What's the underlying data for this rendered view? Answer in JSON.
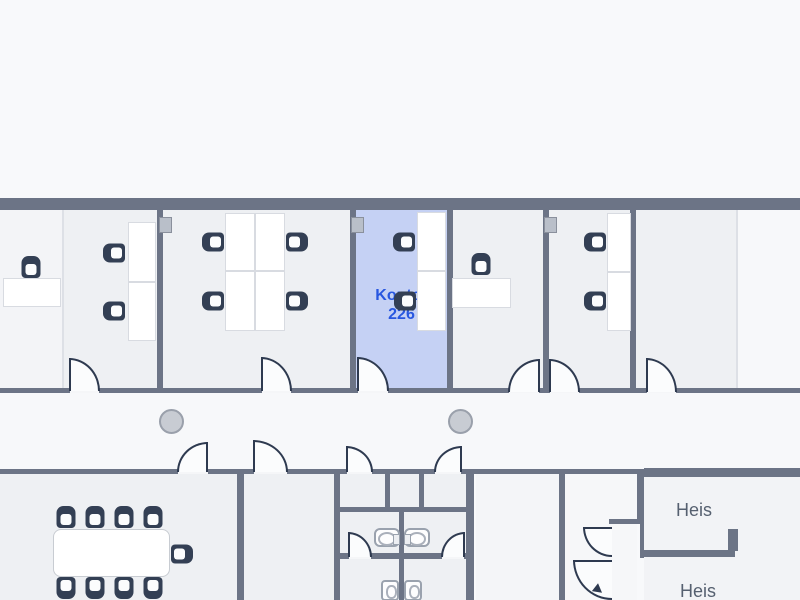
{
  "labels": {
    "room": {
      "line1": "Kontor",
      "line2": "226"
    },
    "elevator_top": "Heis",
    "elevator_bottom": "Heis"
  },
  "colors": {
    "wall": "#6c7486",
    "room_fill": "#eef0f3",
    "corridor_fill": "#f7f8fa",
    "highlight_room_fill": "#c5d1f4",
    "highlight_label": "#2857e0",
    "door_stroke": "#2e3a50",
    "chair": "#333f54",
    "column_fill": "#c8ccd3",
    "elevator_label": "#566070"
  },
  "geometry": {
    "rooms": [
      {
        "r": [
          0,
          210,
          62,
          178
        ],
        "f": "#f3f4f7",
        "name": "open-area-left",
        "i": false
      },
      {
        "r": [
          64,
          210,
          93,
          178
        ],
        "f": "#eef0f3",
        "name": "office-room-1",
        "i": true
      },
      {
        "r": [
          163,
          210,
          187,
          178
        ],
        "f": "#eef0f3",
        "name": "office-room-2",
        "i": true
      },
      {
        "r": [
          356,
          210,
          91,
          178
        ],
        "f": "#c5d1f4",
        "name": "room-kontor-226",
        "i": true
      },
      {
        "r": [
          453,
          210,
          90,
          178
        ],
        "f": "#eef0f3",
        "name": "office-room-3",
        "i": true
      },
      {
        "r": [
          549,
          210,
          81,
          178
        ],
        "f": "#eef0f3",
        "name": "office-room-4",
        "i": true
      },
      {
        "r": [
          636,
          210,
          100,
          178
        ],
        "f": "#eef0f3",
        "name": "office-room-5",
        "i": true
      },
      {
        "r": [
          738,
          210,
          62,
          178
        ],
        "f": "#f7f8fa",
        "name": "open-area-right",
        "i": false
      },
      {
        "r": [
          0,
          393,
          800,
          76
        ],
        "f": "#f7f8fa",
        "name": "corridor",
        "i": false
      },
      {
        "r": [
          0,
          474,
          237,
          126
        ],
        "f": "#eef0f3",
        "name": "meeting-room",
        "i": true
      },
      {
        "r": [
          244,
          474,
          90,
          126
        ],
        "f": "#eef0f3",
        "name": "small-room",
        "i": true
      },
      {
        "r": [
          340,
          474,
          132,
          126
        ],
        "f": "#eef0f3",
        "name": "restroom-area",
        "i": true
      },
      {
        "r": [
          476,
          474,
          83,
          126
        ],
        "f": "#f4f5f8",
        "name": "utility-room",
        "i": true
      },
      {
        "r": [
          565,
          474,
          72,
          126
        ],
        "f": "#f6f7f9",
        "name": "stairwell",
        "i": true
      },
      {
        "r": [
          644,
          477,
          156,
          123
        ],
        "f": "#f2f3f6",
        "name": "elevator-area",
        "i": true
      }
    ],
    "walls": [
      [
        0,
        198,
        800,
        12
      ],
      [
        0,
        388,
        800,
        5
      ],
      [
        0,
        469,
        644,
        5
      ],
      [
        644,
        468,
        156,
        9
      ],
      [
        157,
        210,
        6,
        178
      ],
      [
        350,
        210,
        6,
        178
      ],
      [
        447,
        210,
        6,
        178
      ],
      [
        543,
        210,
        6,
        178
      ],
      [
        630,
        210,
        6,
        178
      ],
      [
        237,
        474,
        7,
        126
      ],
      [
        334,
        474,
        6,
        126
      ],
      [
        385,
        474,
        5,
        38
      ],
      [
        419,
        474,
        5,
        38
      ],
      [
        334,
        507,
        140,
        5
      ],
      [
        399,
        512,
        5,
        88
      ],
      [
        334,
        553,
        140,
        6
      ],
      [
        466,
        474,
        8,
        126
      ],
      [
        559,
        474,
        6,
        126
      ],
      [
        637,
        474,
        7,
        50
      ],
      [
        640,
        524,
        4,
        34
      ],
      [
        609,
        519,
        35,
        5
      ],
      [
        643,
        550,
        92,
        7
      ],
      [
        728,
        529,
        10,
        22
      ]
    ],
    "partitions": [
      [
        62,
        210,
        2,
        178
      ],
      [
        736,
        210,
        2,
        178
      ]
    ],
    "thresholds": [
      [
        70,
        389,
        29,
        4
      ],
      [
        262,
        389,
        29,
        4
      ],
      [
        358,
        389,
        30,
        4
      ],
      [
        509,
        389,
        30,
        4
      ],
      [
        550,
        389,
        29,
        4
      ],
      [
        647,
        389,
        29,
        4
      ],
      [
        178,
        470,
        30,
        4
      ],
      [
        254,
        470,
        33,
        4
      ],
      [
        347,
        470,
        25,
        4
      ],
      [
        435,
        470,
        26,
        4
      ],
      [
        349,
        554,
        22,
        5
      ],
      [
        442,
        554,
        22,
        5
      ]
    ],
    "desks": [
      [
        3,
        278,
        58,
        29
      ],
      [
        128,
        222,
        28,
        60
      ],
      [
        128,
        282,
        28,
        59
      ],
      [
        225,
        213,
        30,
        58
      ],
      [
        255,
        213,
        30,
        58
      ],
      [
        225,
        271,
        30,
        60
      ],
      [
        255,
        271,
        30,
        60
      ],
      [
        417,
        212,
        29,
        59
      ],
      [
        417,
        271,
        29,
        60
      ],
      [
        452,
        278,
        59,
        30
      ],
      [
        607,
        213,
        24,
        59
      ],
      [
        607,
        272,
        24,
        59
      ]
    ],
    "meeting_table": [
      53,
      529,
      117,
      48
    ],
    "chairs": [
      {
        "c": [
          31,
          267
        ],
        "d": "down"
      },
      {
        "c": [
          114,
          253
        ],
        "d": "right"
      },
      {
        "c": [
          114,
          311
        ],
        "d": "right"
      },
      {
        "c": [
          213,
          242
        ],
        "d": "right"
      },
      {
        "c": [
          213,
          301
        ],
        "d": "right"
      },
      {
        "c": [
          297,
          242
        ],
        "d": "left"
      },
      {
        "c": [
          297,
          301
        ],
        "d": "left"
      },
      {
        "c": [
          404,
          242
        ],
        "d": "right"
      },
      {
        "c": [
          405,
          301
        ],
        "d": "right"
      },
      {
        "c": [
          481,
          264
        ],
        "d": "down"
      },
      {
        "c": [
          595,
          242
        ],
        "d": "right"
      },
      {
        "c": [
          595,
          301
        ],
        "d": "right"
      },
      {
        "c": [
          66,
          517
        ],
        "d": "down"
      },
      {
        "c": [
          95,
          517
        ],
        "d": "down"
      },
      {
        "c": [
          124,
          517
        ],
        "d": "down"
      },
      {
        "c": [
          153,
          517
        ],
        "d": "down"
      },
      {
        "c": [
          182,
          554
        ],
        "d": "left"
      },
      {
        "c": [
          66,
          588
        ],
        "d": "up"
      },
      {
        "c": [
          95,
          588
        ],
        "d": "up"
      },
      {
        "c": [
          124,
          588
        ],
        "d": "up"
      },
      {
        "c": [
          153,
          588
        ],
        "d": "up"
      }
    ],
    "doors": [
      {
        "r": [
          69,
          358,
          31,
          33
        ],
        "h": "bl"
      },
      {
        "r": [
          261,
          357,
          31,
          34
        ],
        "h": "bl"
      },
      {
        "r": [
          357,
          357,
          32,
          34
        ],
        "h": "bl"
      },
      {
        "r": [
          508,
          359,
          32,
          33
        ],
        "h": "br"
      },
      {
        "r": [
          549,
          359,
          31,
          33
        ],
        "h": "bl"
      },
      {
        "r": [
          646,
          358,
          31,
          34
        ],
        "h": "bl"
      },
      {
        "r": [
          177,
          442,
          31,
          30
        ],
        "h": "br"
      },
      {
        "r": [
          253,
          440,
          35,
          32
        ],
        "h": "bl"
      },
      {
        "r": [
          346,
          446,
          27,
          26
        ],
        "h": "bl"
      },
      {
        "r": [
          434,
          446,
          28,
          26
        ],
        "h": "br"
      },
      {
        "r": [
          348,
          532,
          24,
          25
        ],
        "h": "bl"
      },
      {
        "r": [
          441,
          532,
          24,
          25
        ],
        "h": "br"
      },
      {
        "r": [
          583,
          527,
          29,
          30
        ],
        "h": "tr"
      },
      {
        "r": [
          573,
          560,
          39,
          40
        ],
        "h": "tr"
      }
    ],
    "columns": [
      [
        171,
        421
      ],
      [
        460,
        421
      ]
    ],
    "wall_boxes": [
      [
        159,
        217
      ],
      [
        351,
        217
      ],
      [
        544,
        217
      ]
    ],
    "sinks": [
      {
        "p": [
          374,
          528
        ],
        "tap": "right"
      },
      {
        "p": [
          404,
          528
        ],
        "tap": "left"
      }
    ],
    "toilets": [
      [
        381,
        580
      ],
      [
        404,
        580
      ]
    ],
    "stair_arrow": {
      "p": [
        594,
        585
      ],
      "angle": 38
    }
  }
}
